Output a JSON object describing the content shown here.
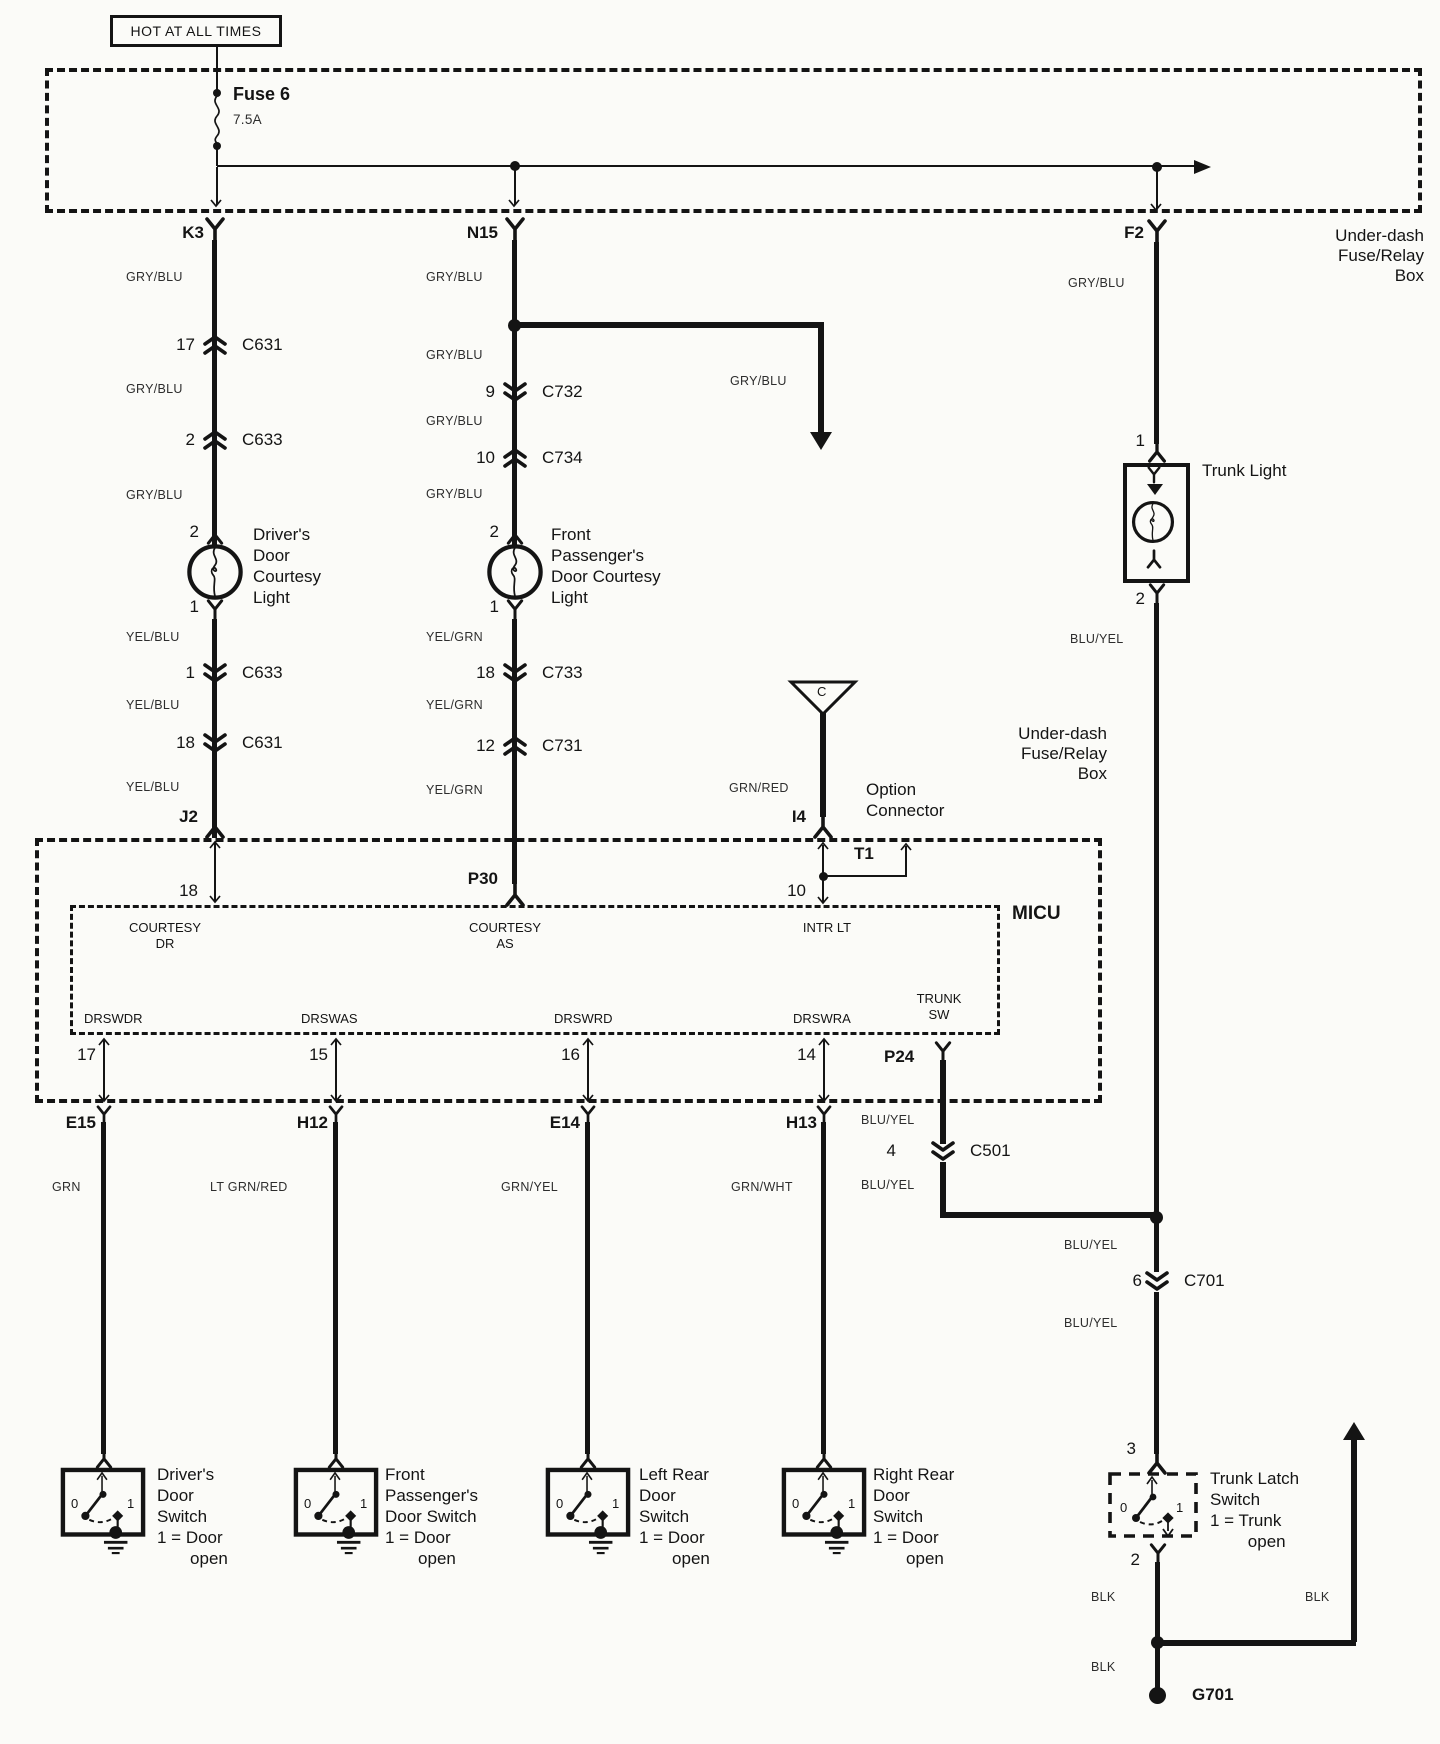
{
  "power": {
    "hot": "HOT AT ALL TIMES",
    "fuse_name": "Fuse 6",
    "fuse_rating": "7.5A",
    "box_label": "Under-dash\nFuse/Relay\nBox",
    "pin_k3": "K3",
    "pin_n15": "N15",
    "pin_f2": "F2"
  },
  "left": {
    "c1": "GRY/BLU",
    "conn1_pin": "17",
    "conn1": "C631",
    "c2": "GRY/BLU",
    "conn2_pin": "2",
    "conn2": "C633",
    "c3": "GRY/BLU",
    "light_pin_top": "2",
    "light": "Driver's\nDoor\nCourtesy\nLight",
    "light_pin_bot": "1",
    "c4": "YEL/BLU",
    "conn3_pin": "1",
    "conn3": "C633",
    "c5": "YEL/BLU",
    "conn4_pin": "18",
    "conn4": "C631",
    "c6": "YEL/BLU",
    "pin_bottom": "J2",
    "micu_pin": "18"
  },
  "mid": {
    "c1": "GRY/BLU",
    "branch_color": "GRY/BLU",
    "c2": "GRY/BLU",
    "conn1_pin": "9",
    "conn1": "C732",
    "c3": "GRY/BLU",
    "conn2_pin": "10",
    "conn2": "C734",
    "c4": "GRY/BLU",
    "light_pin_top": "2",
    "light": "Front\nPassenger's\nDoor Courtesy\nLight",
    "light_pin_bot": "1",
    "c5": "YEL/GRN",
    "conn3_pin": "18",
    "conn3": "C733",
    "c6": "YEL/GRN",
    "conn4_pin": "12",
    "conn4": "C731",
    "c7": "YEL/GRN",
    "pin_bottom": "P30"
  },
  "option": {
    "c": "C",
    "color": "GRN/RED",
    "pin": "I4",
    "label": "Option\nConnector",
    "box_label": "Under-dash\nFuse/Relay\nBox",
    "t1": "T1",
    "micu_pin": "10"
  },
  "micu": {
    "name": "MICU",
    "courtesy_dr": "COURTESY\nDR",
    "courtesy_as": "COURTESY\nAS",
    "intr_lt": "INTR LT",
    "trunk_sw": "TRUNK\nSW",
    "drswdr": "DRSWDR",
    "drswas": "DRSWAS",
    "drswrd": "DRSWRD",
    "drswra": "DRSWRA",
    "pin17": "17",
    "pin15": "15",
    "pin16": "16",
    "pin14": "14",
    "pin_p24": "P24"
  },
  "trunk": {
    "pin1": "1",
    "light": "Trunk Light",
    "pin2": "2",
    "c_light": "BLU/YEL",
    "c_p24a": "BLU/YEL",
    "c501_pin": "4",
    "c501": "C501",
    "c_p24b": "BLU/YEL",
    "c_mid": "BLU/YEL",
    "c701_pin": "6",
    "c701": "C701",
    "c_low": "BLU/YEL",
    "pin3": "3",
    "latch": "Trunk Latch\nSwitch\n1 = Trunk\n        open",
    "latch_zero": "0",
    "latch_one": "1",
    "latch_pin2": "2",
    "blk1": "BLK",
    "blk2": "BLK",
    "blk3": "BLK",
    "ground": "G701"
  },
  "bottom": {
    "e15": "E15",
    "h12": "H12",
    "e14": "E14",
    "h13": "H13",
    "c_e15": "GRN",
    "c_h12": "LT GRN/RED",
    "c_e14": "GRN/YEL",
    "c_h13": "GRN/WHT",
    "switches": [
      {
        "label": "Driver's\nDoor\nSwitch\n1 = Door\n       open",
        "zero": "0",
        "one": "1"
      },
      {
        "label": "Front\nPassenger's\nDoor Switch\n1 = Door\n       open",
        "zero": "0",
        "one": "1"
      },
      {
        "label": "Left Rear\nDoor\nSwitch\n1 = Door\n       open",
        "zero": "0",
        "one": "1"
      },
      {
        "label": "Right Rear\nDoor\nSwitch\n1 = Door\n       open",
        "zero": "0",
        "one": "1"
      }
    ]
  }
}
